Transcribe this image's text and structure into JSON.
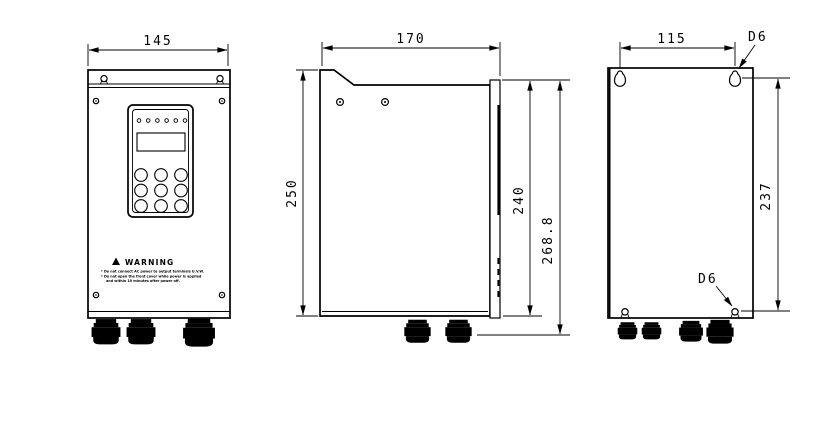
{
  "dimensions": {
    "front_width": "145",
    "side_depth": "170",
    "back_hole_spacing_h": "115",
    "side_height": "250",
    "mount_plate_height": "240",
    "total_height": "268.8",
    "back_hole_spacing_v": "237",
    "hole_dia_top": "D6",
    "hole_dia_bottom": "D6"
  },
  "warning_label": {
    "title": "WARNING",
    "lines": [
      "* Do not connect AC power to output terminals U.V.W.",
      "* Do not open the front cover while power is applied",
      "and within 10 minutes after power off."
    ]
  }
}
